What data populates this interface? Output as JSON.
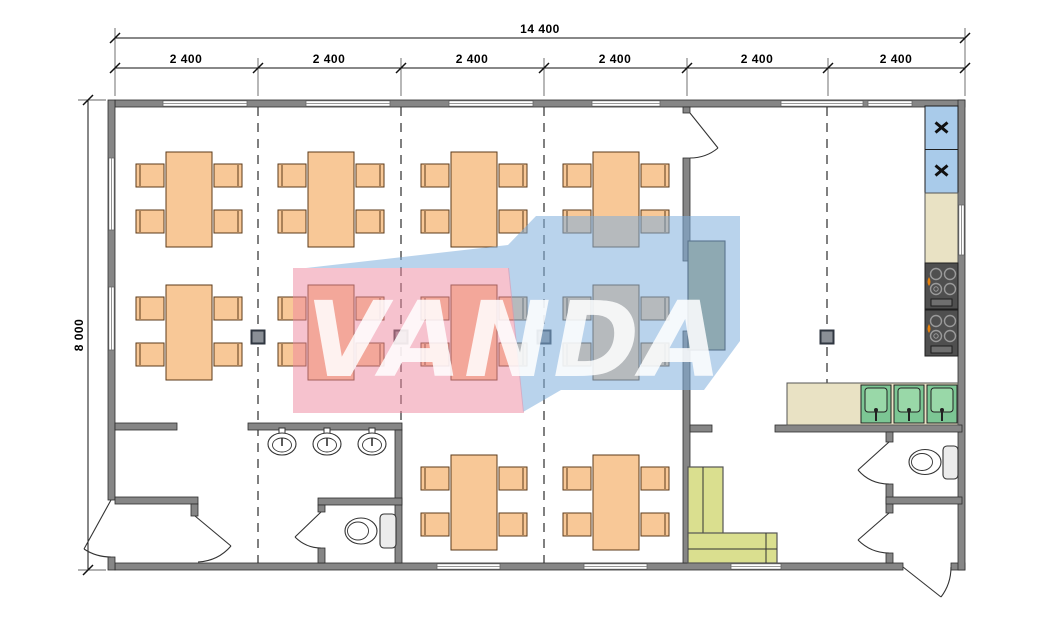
{
  "dimensions": {
    "total_width": "14 400",
    "total_height": "8 000",
    "modules": [
      "2 400",
      "2 400",
      "2 400",
      "2 400",
      "2 400",
      "2 400"
    ]
  },
  "watermark": {
    "text": "VANDA",
    "pink_color": "#ED859D",
    "blue_color": "#7FAEDC"
  },
  "palette": {
    "wall": "#868686",
    "table_wood": "#F8C897",
    "sofa_green": "#DADF8F",
    "sink_green": "#7CC694",
    "fridge_blue": "#A9CBEA",
    "counter_beige": "#E9E2C4",
    "stove_dark": "#4F4F4F",
    "serving_counter_olive": "#9FA37E",
    "flame_accent": "#E8820C"
  }
}
